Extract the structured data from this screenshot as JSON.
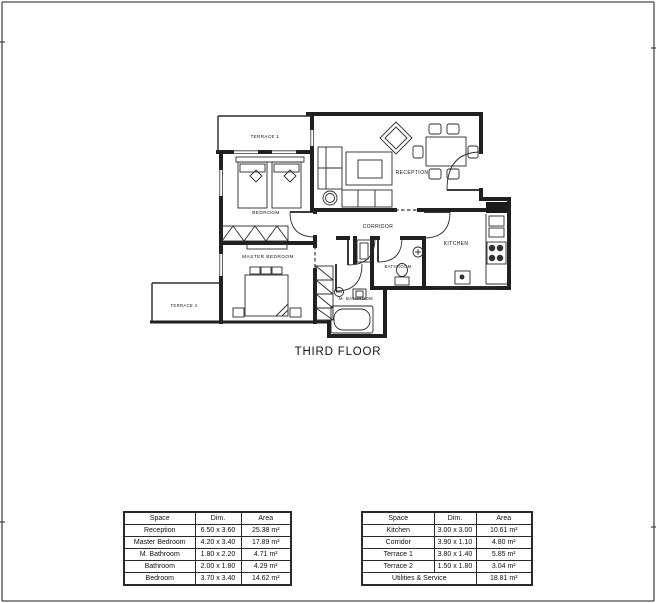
{
  "sheet": {
    "title": "THIRD FLOOR"
  },
  "plan": {
    "rooms": {
      "terrace1": "TERRACE 1",
      "bedroom": "BEDROOM",
      "master_bedroom": "MASTER BEDROOM",
      "terrace2": "TERRACE 2",
      "reception": "RECEPTION",
      "corridor": "CORRIDOR",
      "kitchen": "KITCHEN",
      "bathroom": "BATHROOM",
      "m_bathroom": "M. BATHROOM"
    }
  },
  "tables": [
    {
      "headers": [
        "Space",
        "Dim.",
        "Area"
      ],
      "rows": [
        [
          "Reception",
          "6.50 x 3.60",
          "25.38 m²"
        ],
        [
          "Master Bedroom",
          "4.20 x 3.40",
          "17.89 m²"
        ],
        [
          "M. Bathroom",
          "1.80 x 2.20",
          "4.71 m²"
        ],
        [
          "Bathroom",
          "2.00 x 1.80",
          "4.29 m²"
        ],
        [
          "Bedroom",
          "3.70 x 3.40",
          "14.62 m²"
        ]
      ]
    },
    {
      "headers": [
        "Space",
        "Dim.",
        "Area"
      ],
      "rows": [
        [
          "Kitchen",
          "3.00 x 3.00",
          "10.61 m²"
        ],
        [
          "Corridor",
          "3.90 x 1.10",
          "4.80 m²"
        ],
        [
          "Terrace 1",
          "3.80 x 1.40",
          "5.85 m²"
        ],
        [
          "Terrace 2",
          "1.50 x 1.80",
          "3.04 m²"
        ]
      ],
      "footer": {
        "label": "Utilities & Service",
        "area": "18.81 m²"
      }
    }
  ],
  "colors": {
    "ink": "#141414",
    "wall": "#202020",
    "frame": "#4a4a4a"
  }
}
